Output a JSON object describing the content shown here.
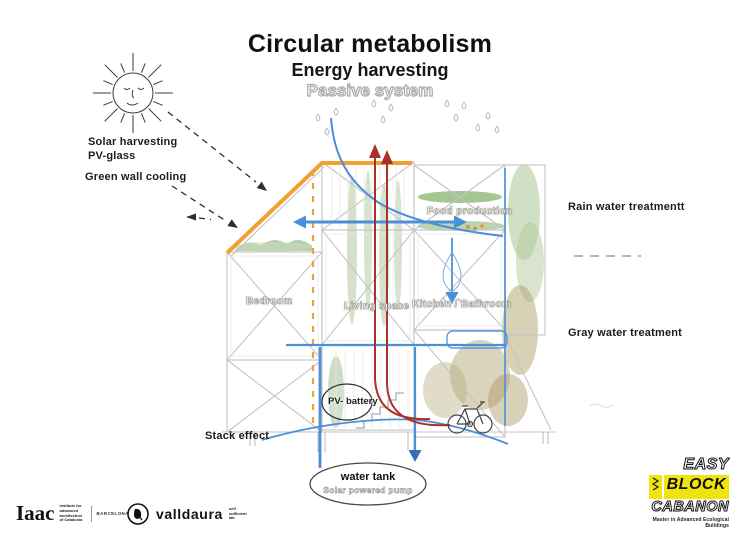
{
  "title": {
    "main": "Circular metabolism",
    "sub": "Energy harvesting",
    "sub2": "Passive system"
  },
  "labels": {
    "solar": "Solar harvesting\nPV-glass",
    "green_wall": "Green wall cooling",
    "rain_water": "Rain water treatmentt",
    "gray_water": "Gray water treatment",
    "stack_effect": "Stack effect",
    "food_production": "Food production",
    "bedroom": "Bedroom",
    "living_space": "Living space",
    "kitchen_bathroom": "Kitchen / Bathroom",
    "pv_battery": "PV- battery",
    "water_tank": "water tank",
    "water_tank_sub": "Solar powered pump"
  },
  "logos": {
    "iaac": {
      "name": "Iaac",
      "desc": "institute for\nadvanced\narchitecture\nof Catalonia",
      "city": "BARCELONA"
    },
    "valldaura": {
      "name": "valldaura",
      "desc": "self\nsufficient\nlab"
    },
    "maeb": {
      "line1": "EASY",
      "line2": "BLOCK",
      "line3": "CABANON",
      "tagline": "Master in Advanced Ecological Buildings"
    }
  },
  "colors": {
    "roof_orange": "#F0A132",
    "water_blue": "#4A90D9",
    "heat_red": "#A93226",
    "accent_yellow": "#F0E40C"
  }
}
